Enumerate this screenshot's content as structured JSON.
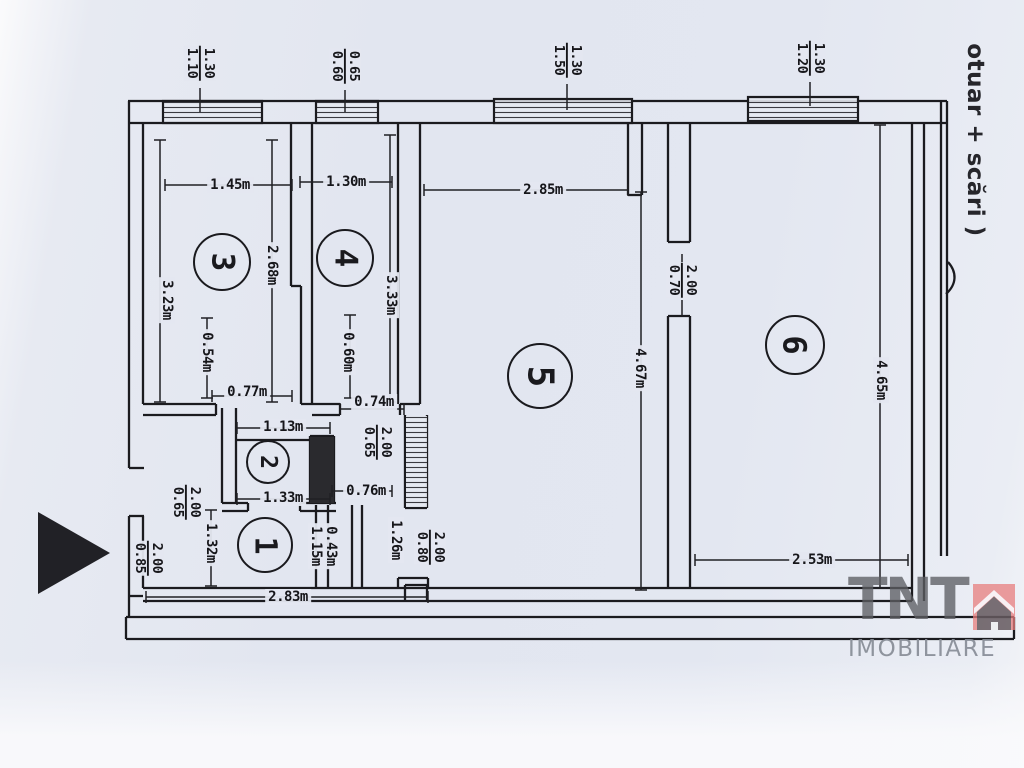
{
  "side_note": "otuar + scări )",
  "logo": {
    "brand": "TNT",
    "subtitle": "IMOBILIARE",
    "accent_color": "#e87e7e",
    "house_color": "#56565c"
  },
  "rooms": [
    {
      "num": "3",
      "x": 222,
      "y": 262,
      "r": 27
    },
    {
      "num": "4",
      "x": 345,
      "y": 258,
      "r": 27
    },
    {
      "num": "5",
      "x": 540,
      "y": 376,
      "r": 31
    },
    {
      "num": "6",
      "x": 795,
      "y": 345,
      "r": 28
    },
    {
      "num": "2",
      "x": 268,
      "y": 462,
      "r": 20
    },
    {
      "num": "1",
      "x": 265,
      "y": 545,
      "r": 26
    }
  ],
  "h_dims": [
    {
      "text": "1.45m",
      "x": 230,
      "y": 185
    },
    {
      "text": "1.30m",
      "x": 346,
      "y": 182
    },
    {
      "text": "2.85m",
      "x": 543,
      "y": 190
    },
    {
      "text": "0.77m",
      "x": 247,
      "y": 392
    },
    {
      "text": "0.74m",
      "x": 374,
      "y": 402
    },
    {
      "text": "1.13m",
      "x": 283,
      "y": 427
    },
    {
      "text": "1.33m",
      "x": 283,
      "y": 498
    },
    {
      "text": "0.76m",
      "x": 366,
      "y": 491
    },
    {
      "text": "2.83m",
      "x": 288,
      "y": 597
    },
    {
      "text": "2.53m",
      "x": 812,
      "y": 560
    }
  ],
  "v_dims": [
    {
      "text": "3.23m",
      "x": 167,
      "y": 300
    },
    {
      "text": "2.68m",
      "x": 272,
      "y": 265
    },
    {
      "text": "3.33m",
      "x": 391,
      "y": 295
    },
    {
      "text": "0.54m",
      "x": 207,
      "y": 352
    },
    {
      "text": "0.60m",
      "x": 348,
      "y": 352
    },
    {
      "text": "4.67m",
      "x": 640,
      "y": 368
    },
    {
      "text": "4.65m",
      "x": 881,
      "y": 380
    },
    {
      "text": "1.32m",
      "x": 211,
      "y": 543
    },
    {
      "text": "1.15m",
      "x": 316,
      "y": 546
    },
    {
      "text": "0.43m",
      "x": 331,
      "y": 546
    },
    {
      "text": "1.26m",
      "x": 396,
      "y": 540
    }
  ],
  "fractions": [
    {
      "w": "1.10",
      "h": "1.30",
      "x": 200,
      "y": 63
    },
    {
      "w": "0.60",
      "h": "0.65",
      "x": 345,
      "y": 66
    },
    {
      "w": "1.50",
      "h": "1.30",
      "x": 567,
      "y": 60
    },
    {
      "w": "1.20",
      "h": "1.30",
      "x": 810,
      "y": 58
    },
    {
      "w": "0.70",
      "h": "2.00",
      "x": 682,
      "y": 280
    },
    {
      "w": "0.65",
      "h": "2.00",
      "x": 377,
      "y": 442
    },
    {
      "w": "0.65",
      "h": "2.00",
      "x": 186,
      "y": 502
    },
    {
      "w": "0.85",
      "h": "2.00",
      "x": 148,
      "y": 558
    },
    {
      "w": "0.80",
      "h": "2.00",
      "x": 430,
      "y": 547
    }
  ]
}
